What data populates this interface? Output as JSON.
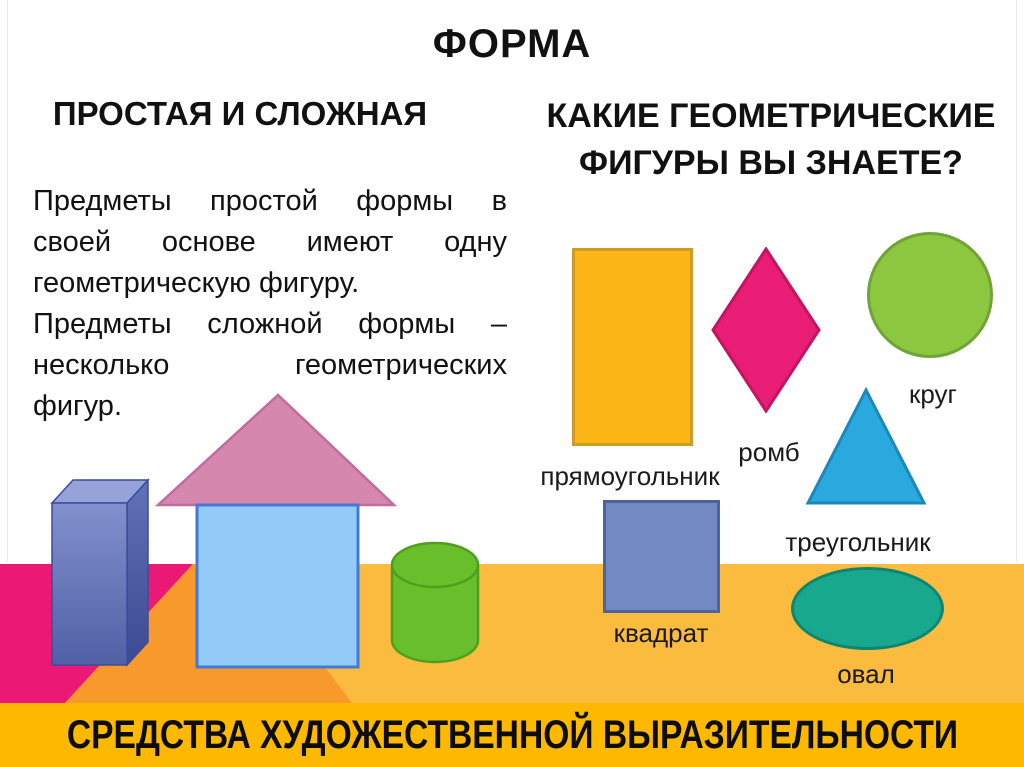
{
  "slide": {
    "title": "ФОРМА",
    "left_section": {
      "heading": "ПРОСТАЯ И СЛОЖНАЯ",
      "body_lines": [
        "Предметы простой формы в",
        "своей основе имеют одну",
        "геометрическую фигуру.",
        "Предметы сложной формы –",
        "несколько геометрических",
        "фигур."
      ]
    },
    "right_section": {
      "heading": "КАКИЕ ГЕОМЕТРИЧЕСКИЕ ФИГУРЫ ВЫ ЗНАЕТЕ?",
      "shape_labels": {
        "rectangle": "прямоугольник",
        "rhombus": "ромб",
        "circle": "круг",
        "square": "квадрат",
        "triangle": "треугольник",
        "oval": "овал"
      }
    },
    "footer_banner": "СРЕДСТВА ХУДОЖЕСТВЕННОЙ ВЫРАЗИТЕЛЬНОСТИ",
    "colors": {
      "rectangle_fill": "#FCB716",
      "rectangle_stroke": "#D29A28",
      "rhombus_fill": "#E91D75",
      "rhombus_stroke": "#C2155F",
      "circle_fill": "#8DC63F",
      "circle_stroke": "#6FA436",
      "square_fill": "#7389C4",
      "square_stroke": "#4E639E",
      "triangle_fill": "#29A9DD",
      "triangle_stroke": "#1C87B8",
      "oval_fill": "#18A88E",
      "oval_stroke": "#0C8671",
      "ground_yellow": "#FBBB3F",
      "ground_magenta": "#EB1876",
      "ground_orange": "#F8992B",
      "banner_gold": "#FCB900",
      "house_body": "#92CBF7",
      "house_border": "#4379D8",
      "roof_pink": "#D687AE",
      "roof_border": "#C06C9D",
      "cylinder_green": "#68BE2B",
      "cylinder_border": "#4F9F1F",
      "prism_blue": "#5F70B5"
    }
  }
}
